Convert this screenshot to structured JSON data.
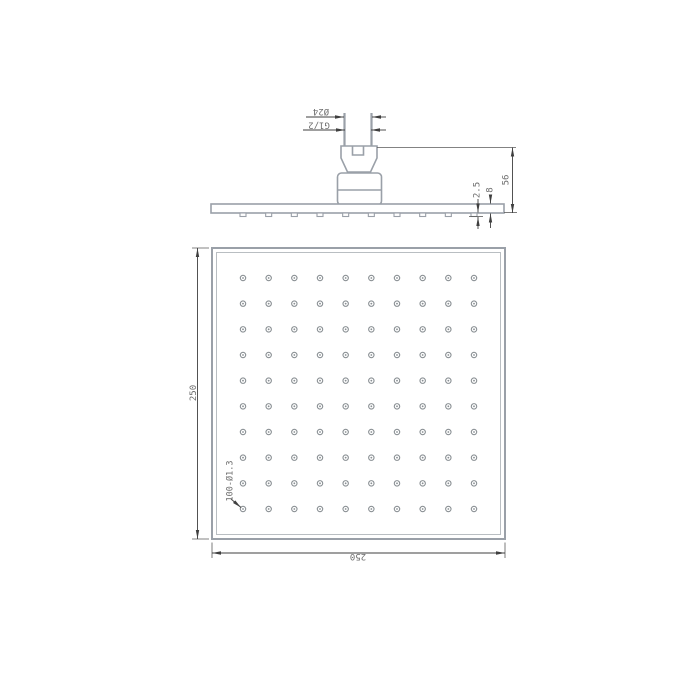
{
  "canvas": {
    "width": 700,
    "height": 700,
    "background": "#ffffff"
  },
  "colors": {
    "part_outline": "#9aa0a8",
    "inner_edge": "#c9cdd0",
    "dimension_lines": "#3f3f3f",
    "dimension_text": "#6e6e6e",
    "background": "#ffffff"
  },
  "side_view": {
    "labels": {
      "outer_diameter": "Ø24",
      "thread": "G1/2",
      "height": "56",
      "plate_thickness": "8",
      "nozzle_protrusion": "2.5"
    }
  },
  "plan_view": {
    "labels": {
      "width": "250",
      "height": "250",
      "holes": "100-Ø1.3"
    },
    "hole_grid": {
      "rows": 10,
      "cols": 10,
      "total_holes": 100,
      "hole_diameter_label": "Ø1.3",
      "start_x": 243,
      "start_y": 278,
      "spacing_x": 25.667,
      "spacing_y": 25.667,
      "outer_radius": 2.7,
      "dot_radius": 0.9
    },
    "nozzle_row": {
      "y": 213,
      "width": 6,
      "height": 3.5
    }
  }
}
